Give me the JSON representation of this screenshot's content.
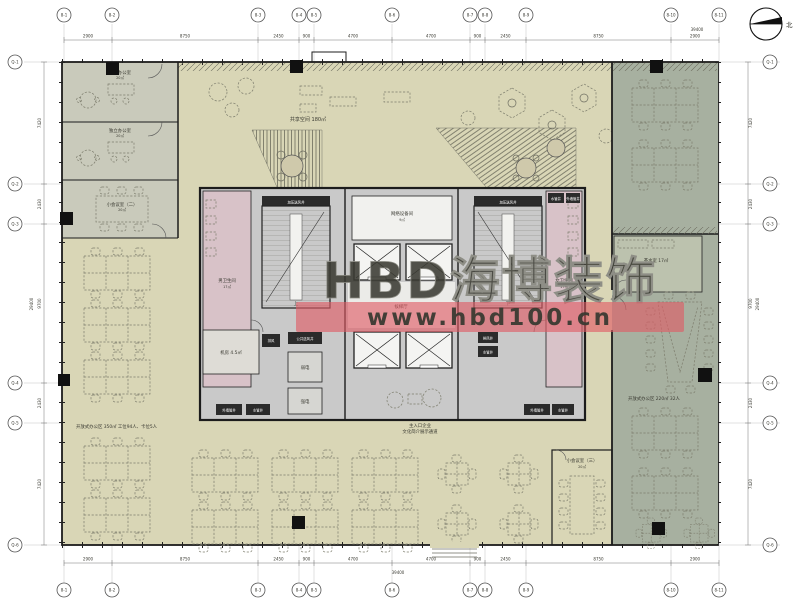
{
  "watermark": {
    "brand": "HBD海博装饰",
    "url": "www.hbd100.cn"
  },
  "compass": {
    "label": "北"
  },
  "grid": {
    "top_labels": [
      "8-1",
      "8-2",
      "8-3",
      "8-4",
      "8-5",
      "8-6",
      "8-7",
      "8-8",
      "8-9",
      "8-10",
      "8-11"
    ],
    "bottom_labels": [
      "8-1",
      "8-2",
      "8-3",
      "8-4",
      "8-5",
      "8-6",
      "8-7",
      "8-8",
      "8-9",
      "8-10",
      "8-11"
    ],
    "left_labels": [
      "Q-1",
      "Q-2",
      "Q-3",
      "Q-4",
      "Q-5",
      "Q-6"
    ],
    "right_labels": [
      "Q-1",
      "Q-2",
      "Q-3",
      "Q-4",
      "Q-5",
      "Q-6"
    ],
    "dims_top": [
      "2900",
      "8750",
      "2450",
      "900",
      "4700",
      "4700",
      "900",
      "2450",
      "8750",
      "2900"
    ],
    "dims_bottom": [
      "2900",
      "8750",
      "2450",
      "900",
      "4700",
      "4700",
      "900",
      "2450",
      "8750",
      "2900"
    ],
    "dims_left": [
      "7420",
      "2430",
      "9700",
      "2430",
      "7420"
    ],
    "dims_right": [
      "7420",
      "2430",
      "9700",
      "2430",
      "7420"
    ],
    "total_width": "39400",
    "total_height": "29400"
  },
  "rooms": {
    "shared_space": {
      "label": "共享空间 180㎡"
    },
    "independent_office": {
      "name": "独立办公室",
      "area": "20㎡"
    },
    "meeting_room_2": {
      "name": "小会议室（二）",
      "area": "20㎡"
    },
    "meeting_room_3": {
      "name": "小会议室（三）",
      "area": "20㎡"
    },
    "open_office_left": {
      "label": "开放式办公区 350㎡ 工位94人、卡位5人"
    },
    "open_office_right": {
      "label": "开放式办公区 220㎡ 32人"
    },
    "tea_room": {
      "label": "茶水室 17㎡"
    },
    "mens_restroom": {
      "name": "男卫生间",
      "area": "17㎡"
    },
    "womens_restroom": {
      "name": "女卫生间",
      "area": "17㎡"
    },
    "network_room": {
      "name": "网络设备间",
      "area": "9㎡"
    },
    "elevator_lobby": {
      "label": "候梯厅"
    },
    "machine_room": {
      "label": "机房 4.5㎡"
    },
    "entrance": {
      "line1": "主入口企业",
      "line2": "文化简介展示通道"
    }
  },
  "shafts": {
    "pressurized_air": "加压送风井",
    "exhaust": "排风",
    "exhaust_shaft": "排风井",
    "public_air": "公共送风井",
    "weak_power": "弱电",
    "strong_power": "强电",
    "wall_pipe": "外墙管井",
    "water_pipe": "水管井"
  },
  "stairs": {
    "up": "上",
    "down": "下"
  },
  "colors": {
    "floor": "#d9d6b6",
    "left_rooms": "#c9cabb",
    "right_strip": "#a7b0a0",
    "right_room": "#bcc2ae",
    "core": "#c9c9c9",
    "restroom": "#d8c2c8",
    "banner": "#e05a64",
    "wall": "#1c1c1c"
  }
}
